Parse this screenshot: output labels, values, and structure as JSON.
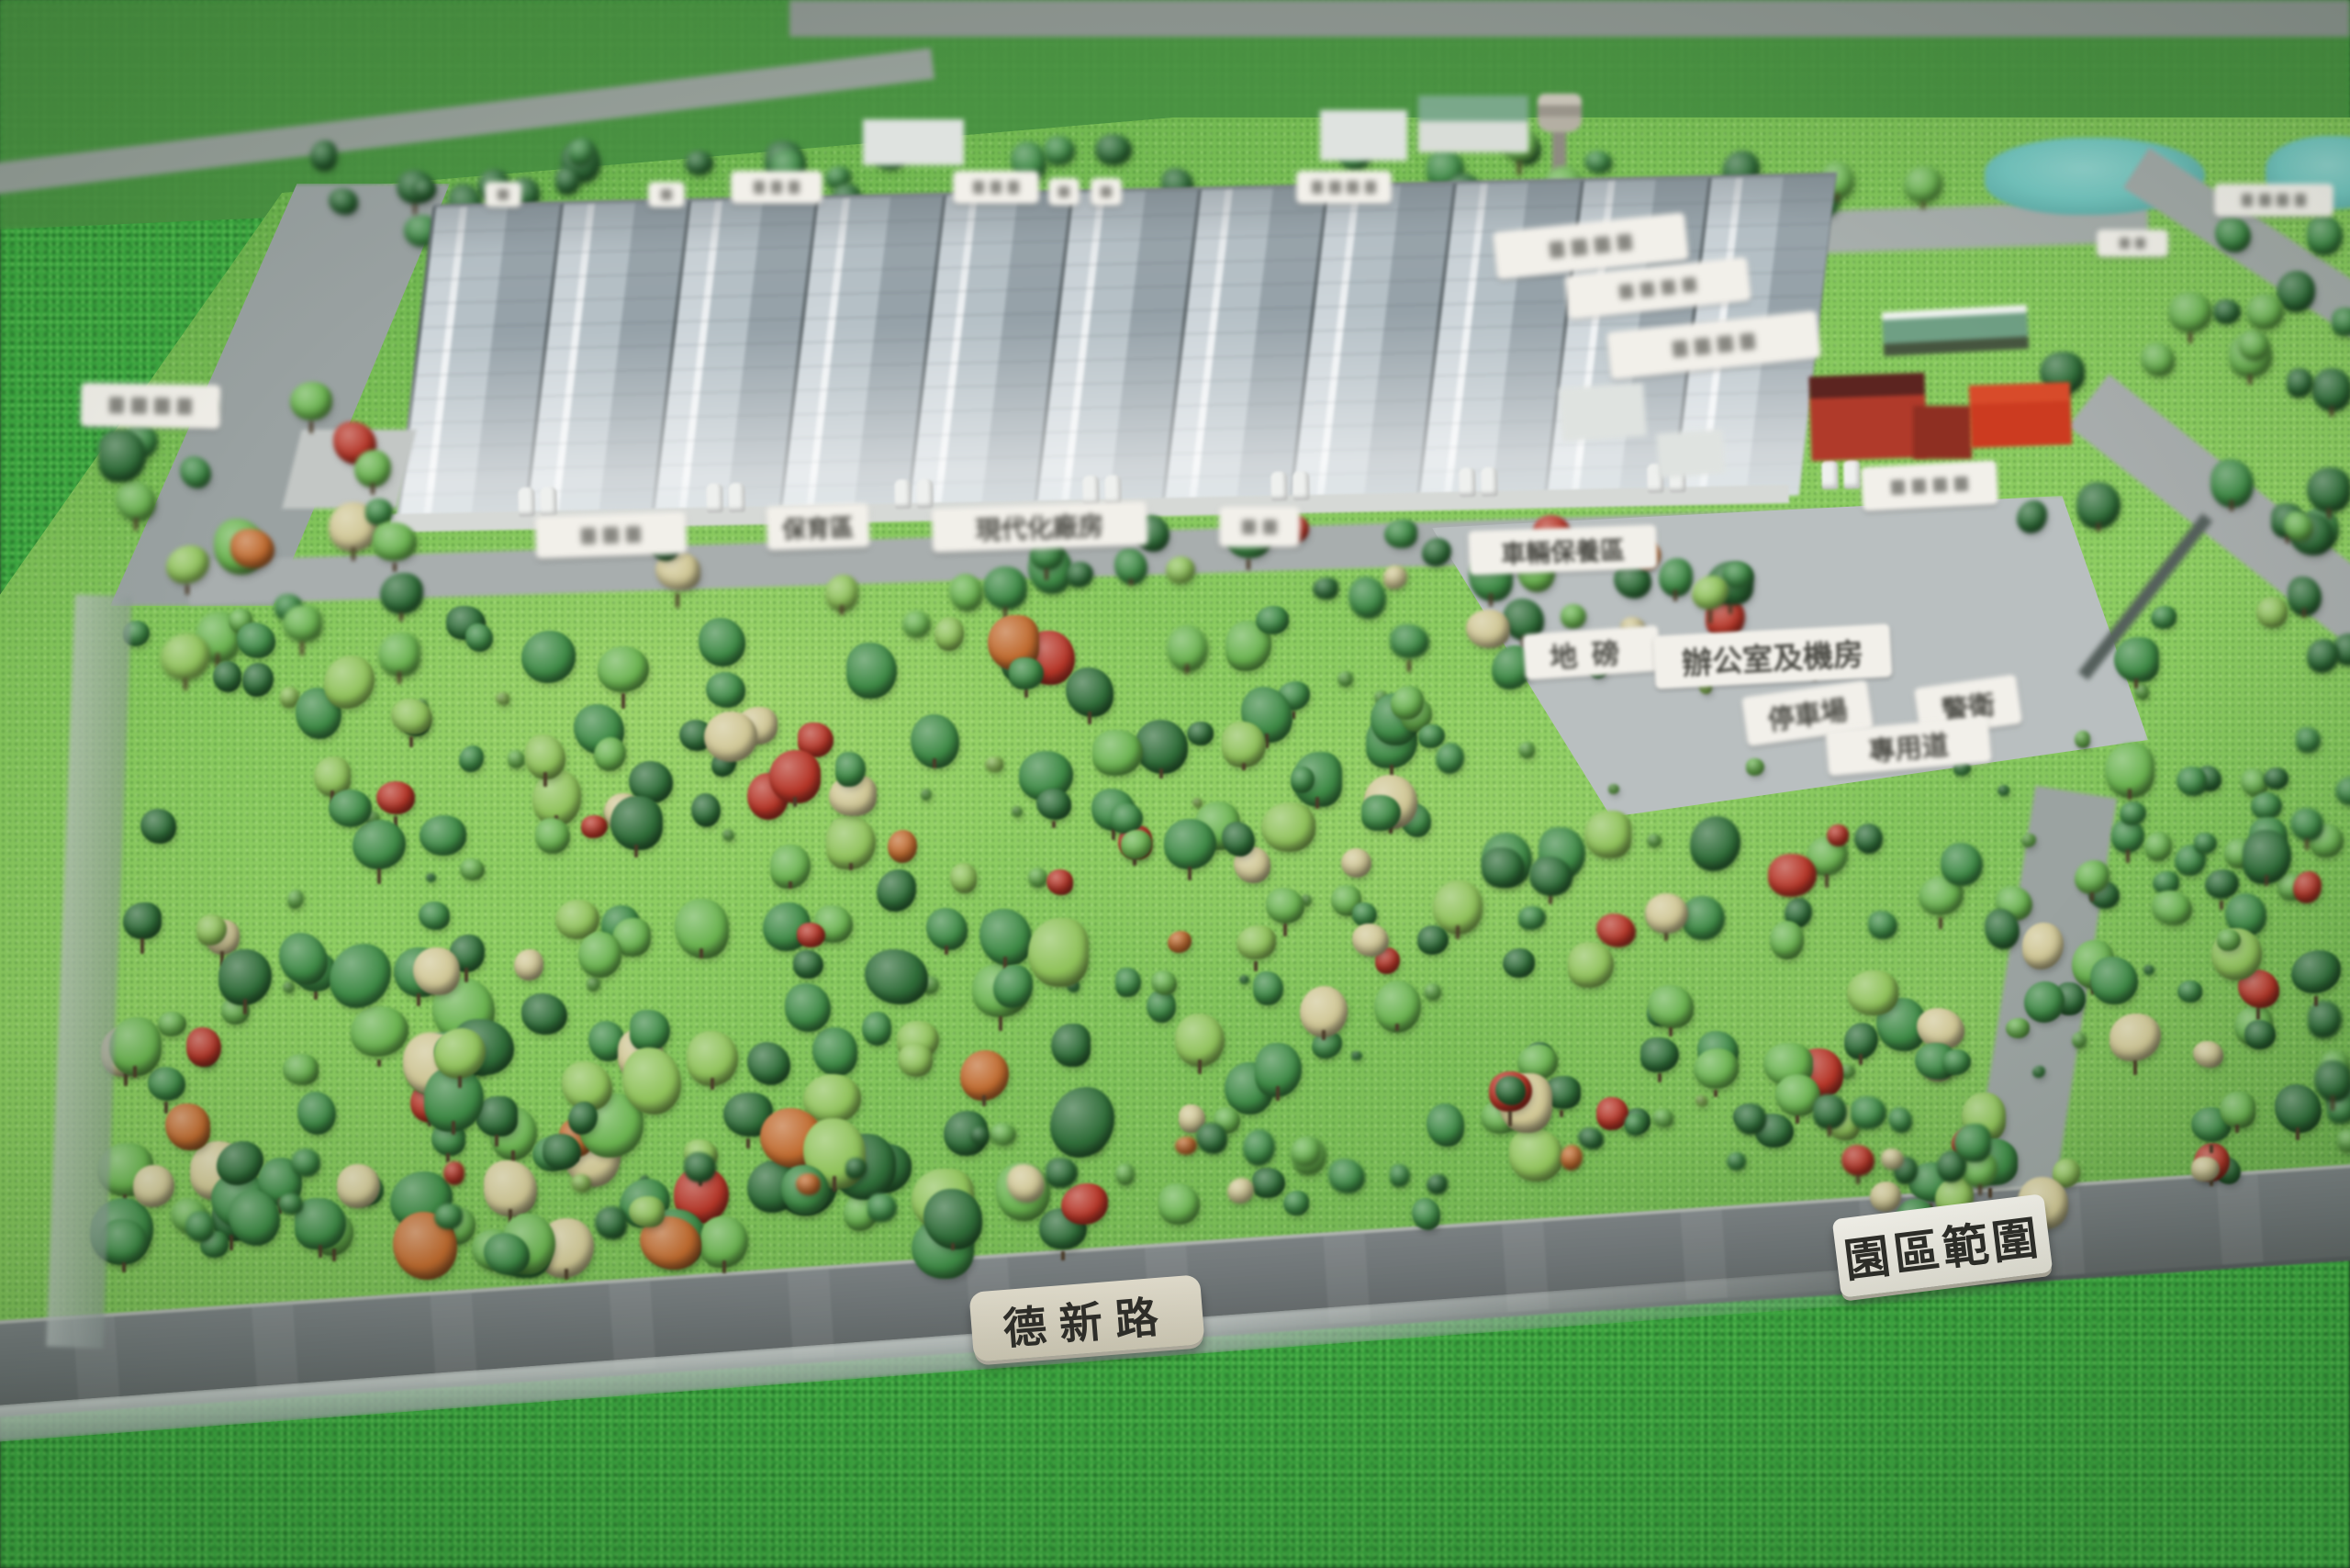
{
  "labels": {
    "road_name": "德新路",
    "park_boundary": "園區範圍",
    "office_machine_room": "辦公室及機房",
    "weighbridge": "地磅",
    "parking_lot": "停車場",
    "guard": "警衛",
    "dedicated_lane": "專用道",
    "conservation_area": "保育區",
    "modern_factory": "現代化廠房",
    "vehicle_maintenance_area": "車輛保養區"
  },
  "colors": {
    "foreground_grass": "#3aa83f",
    "platform_grass": "#86c75d",
    "backdrop_grass": "#4f9a46",
    "road_gray": "#6e7476",
    "factory_roof": "#bfc9d0",
    "red_building": "#c23b22",
    "pond_teal": "#78c6c0",
    "label_plate": "#f4f1e8",
    "road_plate_beige": "#d8d2c0",
    "label_text": "#35332e",
    "tree_palette": [
      "#2f6d38",
      "#3e8a45",
      "#6ab34f",
      "#8fc25a",
      "#cfc694",
      "#b53527",
      "#bf6a2e"
    ]
  }
}
